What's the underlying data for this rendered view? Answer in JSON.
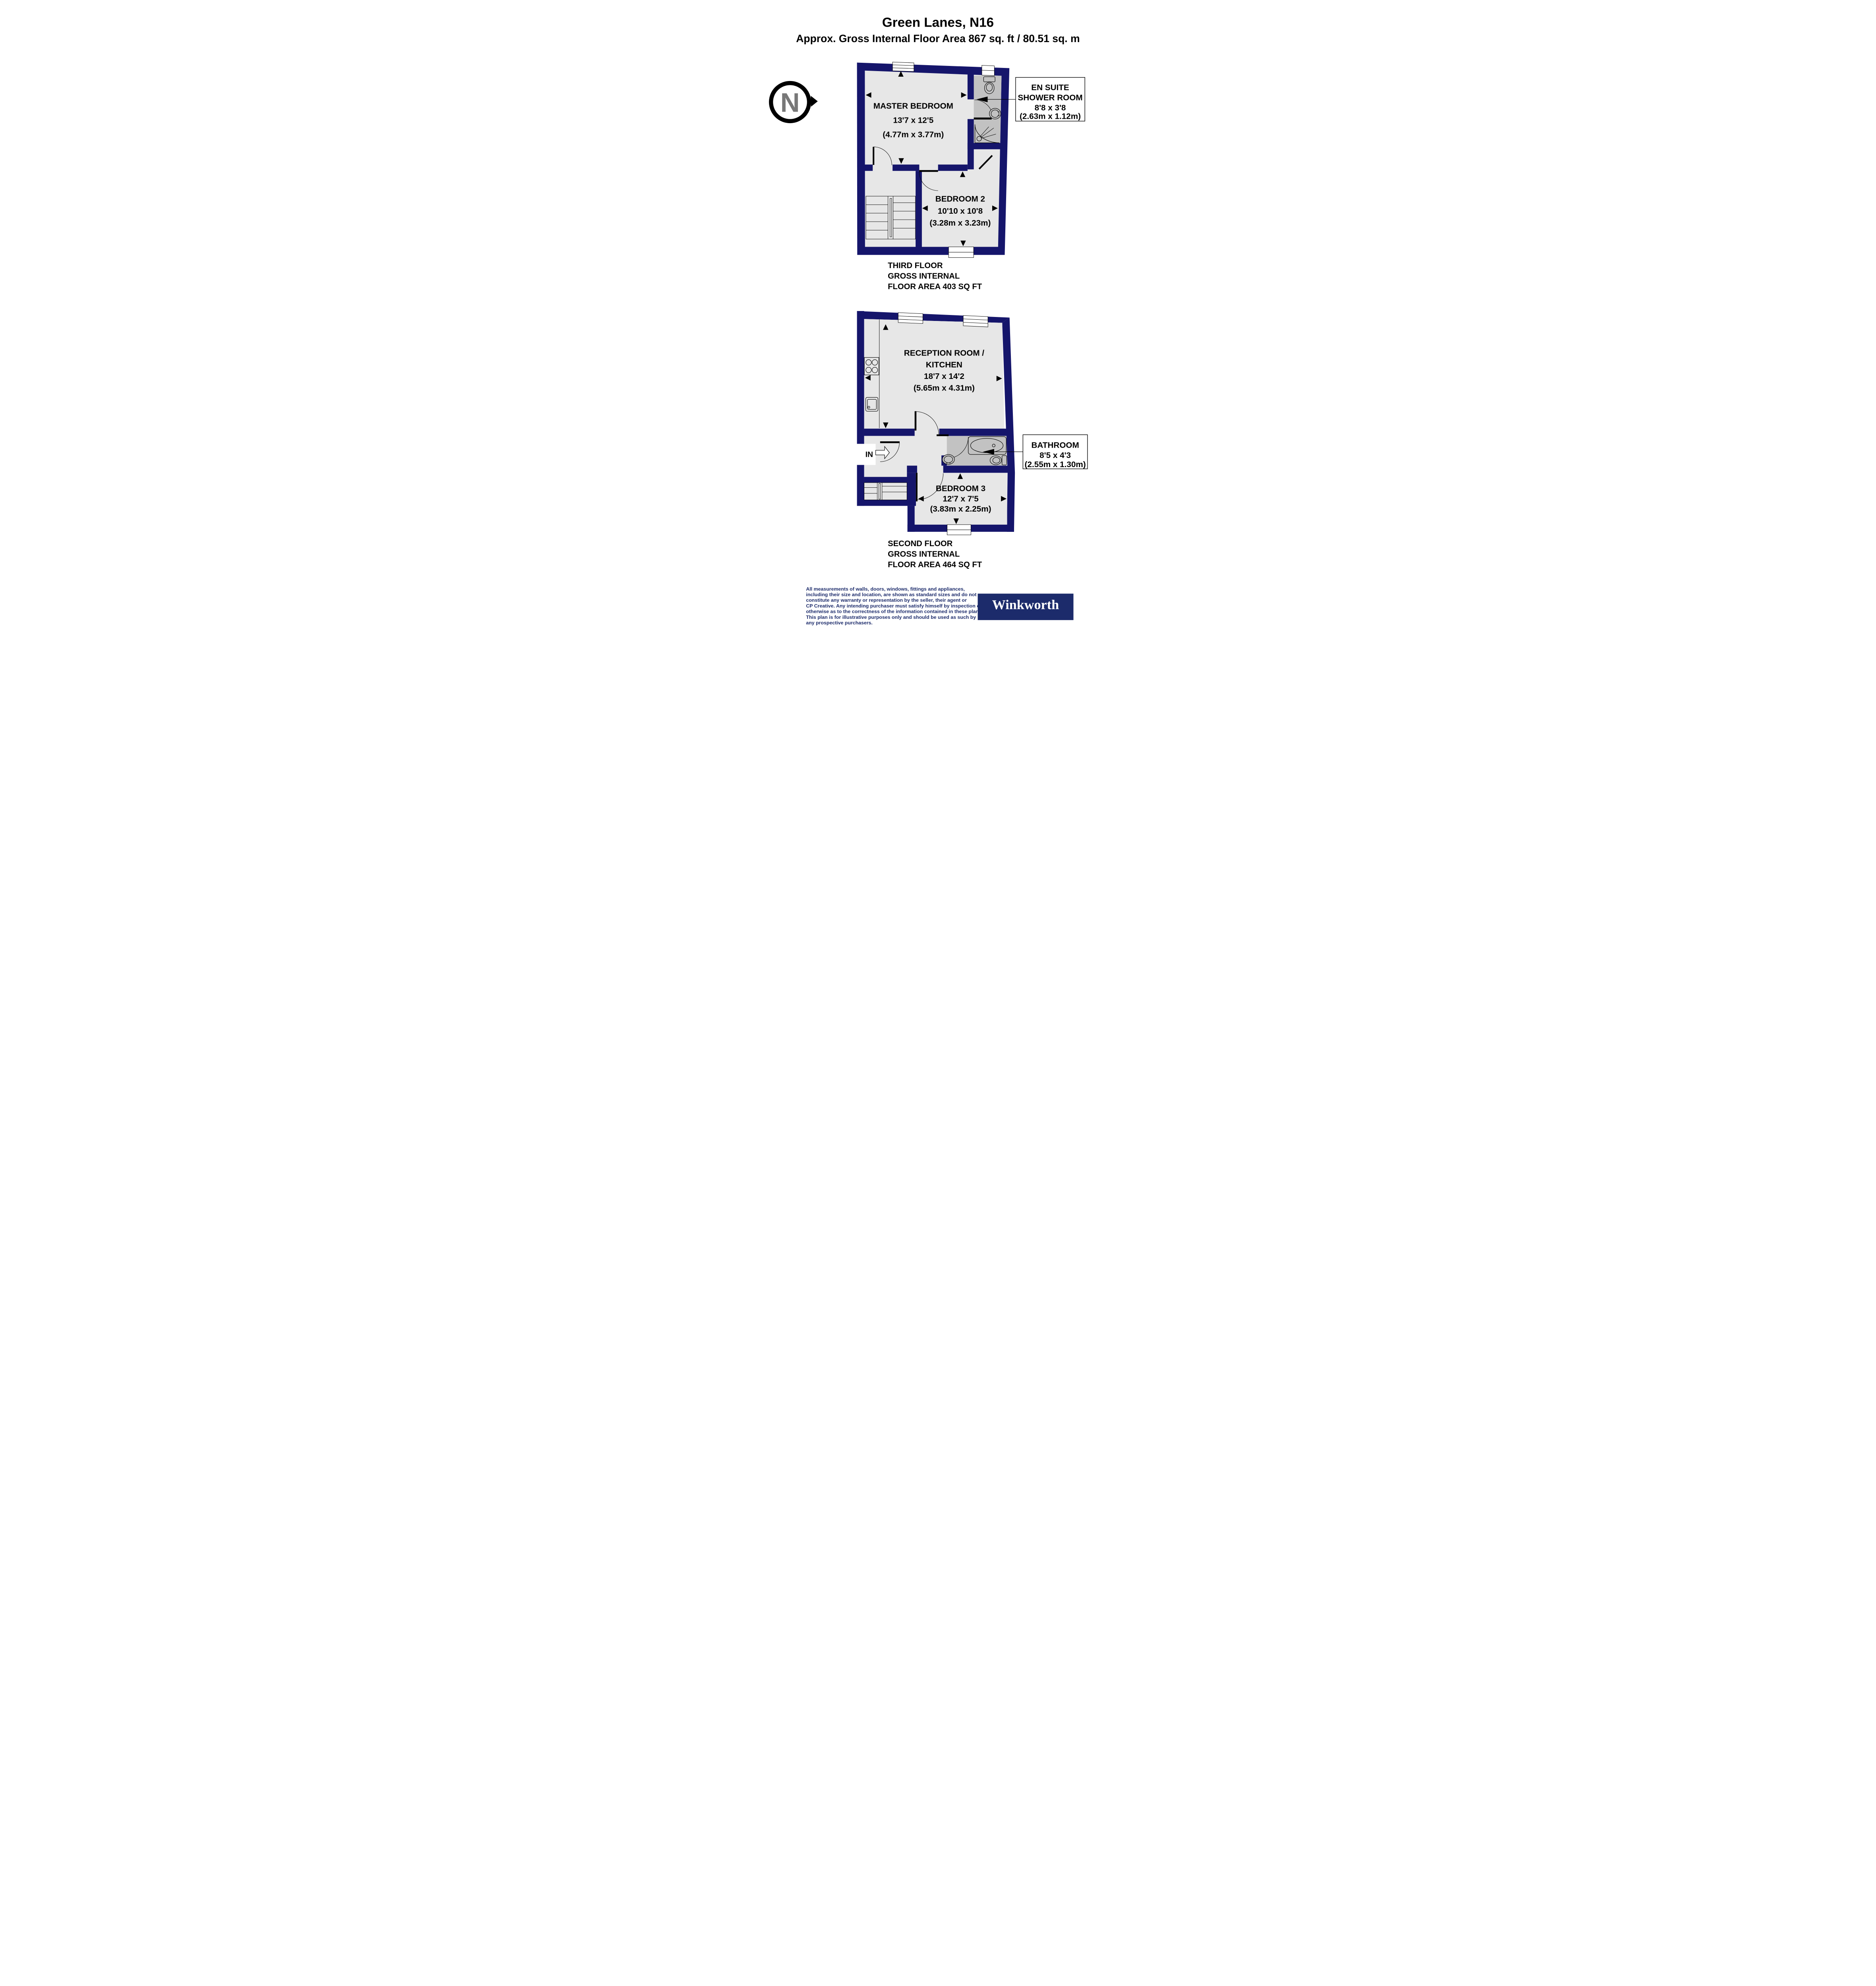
{
  "title": {
    "line1": "Green Lanes, N16",
    "line2": "Approx. Gross Internal Floor Area 867 sq. ft / 80.51 sq. m"
  },
  "north": {
    "label": "N"
  },
  "floors": {
    "third": {
      "caption_line1": "THIRD FLOOR",
      "caption_line2": "GROSS INTERNAL",
      "caption_line3": "FLOOR AREA 403 SQ FT",
      "rooms": {
        "master_bedroom": {
          "name": "MASTER BEDROOM",
          "imperial": "13'7 x 12'5",
          "metric": "(4.77m x 3.77m)"
        },
        "bedroom2": {
          "name": "BEDROOM 2",
          "imperial": "10'10 x 10'8",
          "metric": "(3.28m x 3.23m)"
        },
        "en_suite": {
          "name_line1": "EN SUITE",
          "name_line2": "SHOWER ROOM",
          "imperial": "8'8 x 3'8",
          "metric": "(2.63m x 1.12m)"
        }
      }
    },
    "second": {
      "caption_line1": "SECOND FLOOR",
      "caption_line2": "GROSS INTERNAL",
      "caption_line3": "FLOOR AREA 464 SQ FT",
      "entrance_label": "IN",
      "rooms": {
        "reception_kitchen": {
          "name_line1": "RECEPTION ROOM /",
          "name_line2": "KITCHEN",
          "imperial": "18'7 x 14'2",
          "metric": "(5.65m x 4.31m)"
        },
        "bathroom": {
          "name": "BATHROOM",
          "imperial": "8'5 x 4'3",
          "metric": "(2.55m x 1.30m)"
        },
        "bedroom3": {
          "name": "BEDROOM 3",
          "imperial": "12'7 x 7'5",
          "metric": "(3.83m x 2.25m)"
        }
      }
    }
  },
  "footer": {
    "disclaimer_lines": [
      "All measurements of walls, doors, windows, fittings and appliances,",
      "including their size and location, are shown as standard sizes and do not",
      "constitute any warranty or representation by the seller, their agent or",
      "CP Creative. Any intending purchaser must satisfy himself by inspection or",
      "otherwise as to the correctness of the information contained in these plans.",
      "This plan is for illustrative purposes only and should be used as such by",
      "any prospective purchasers."
    ],
    "logo_text": "Winkworth"
  },
  "colors": {
    "wall": "#15156b",
    "floor": "#e7e7e7",
    "wet_floor": "#c2c2c2",
    "navy_text": "#1c2b6b",
    "north_letter": "#787878"
  }
}
